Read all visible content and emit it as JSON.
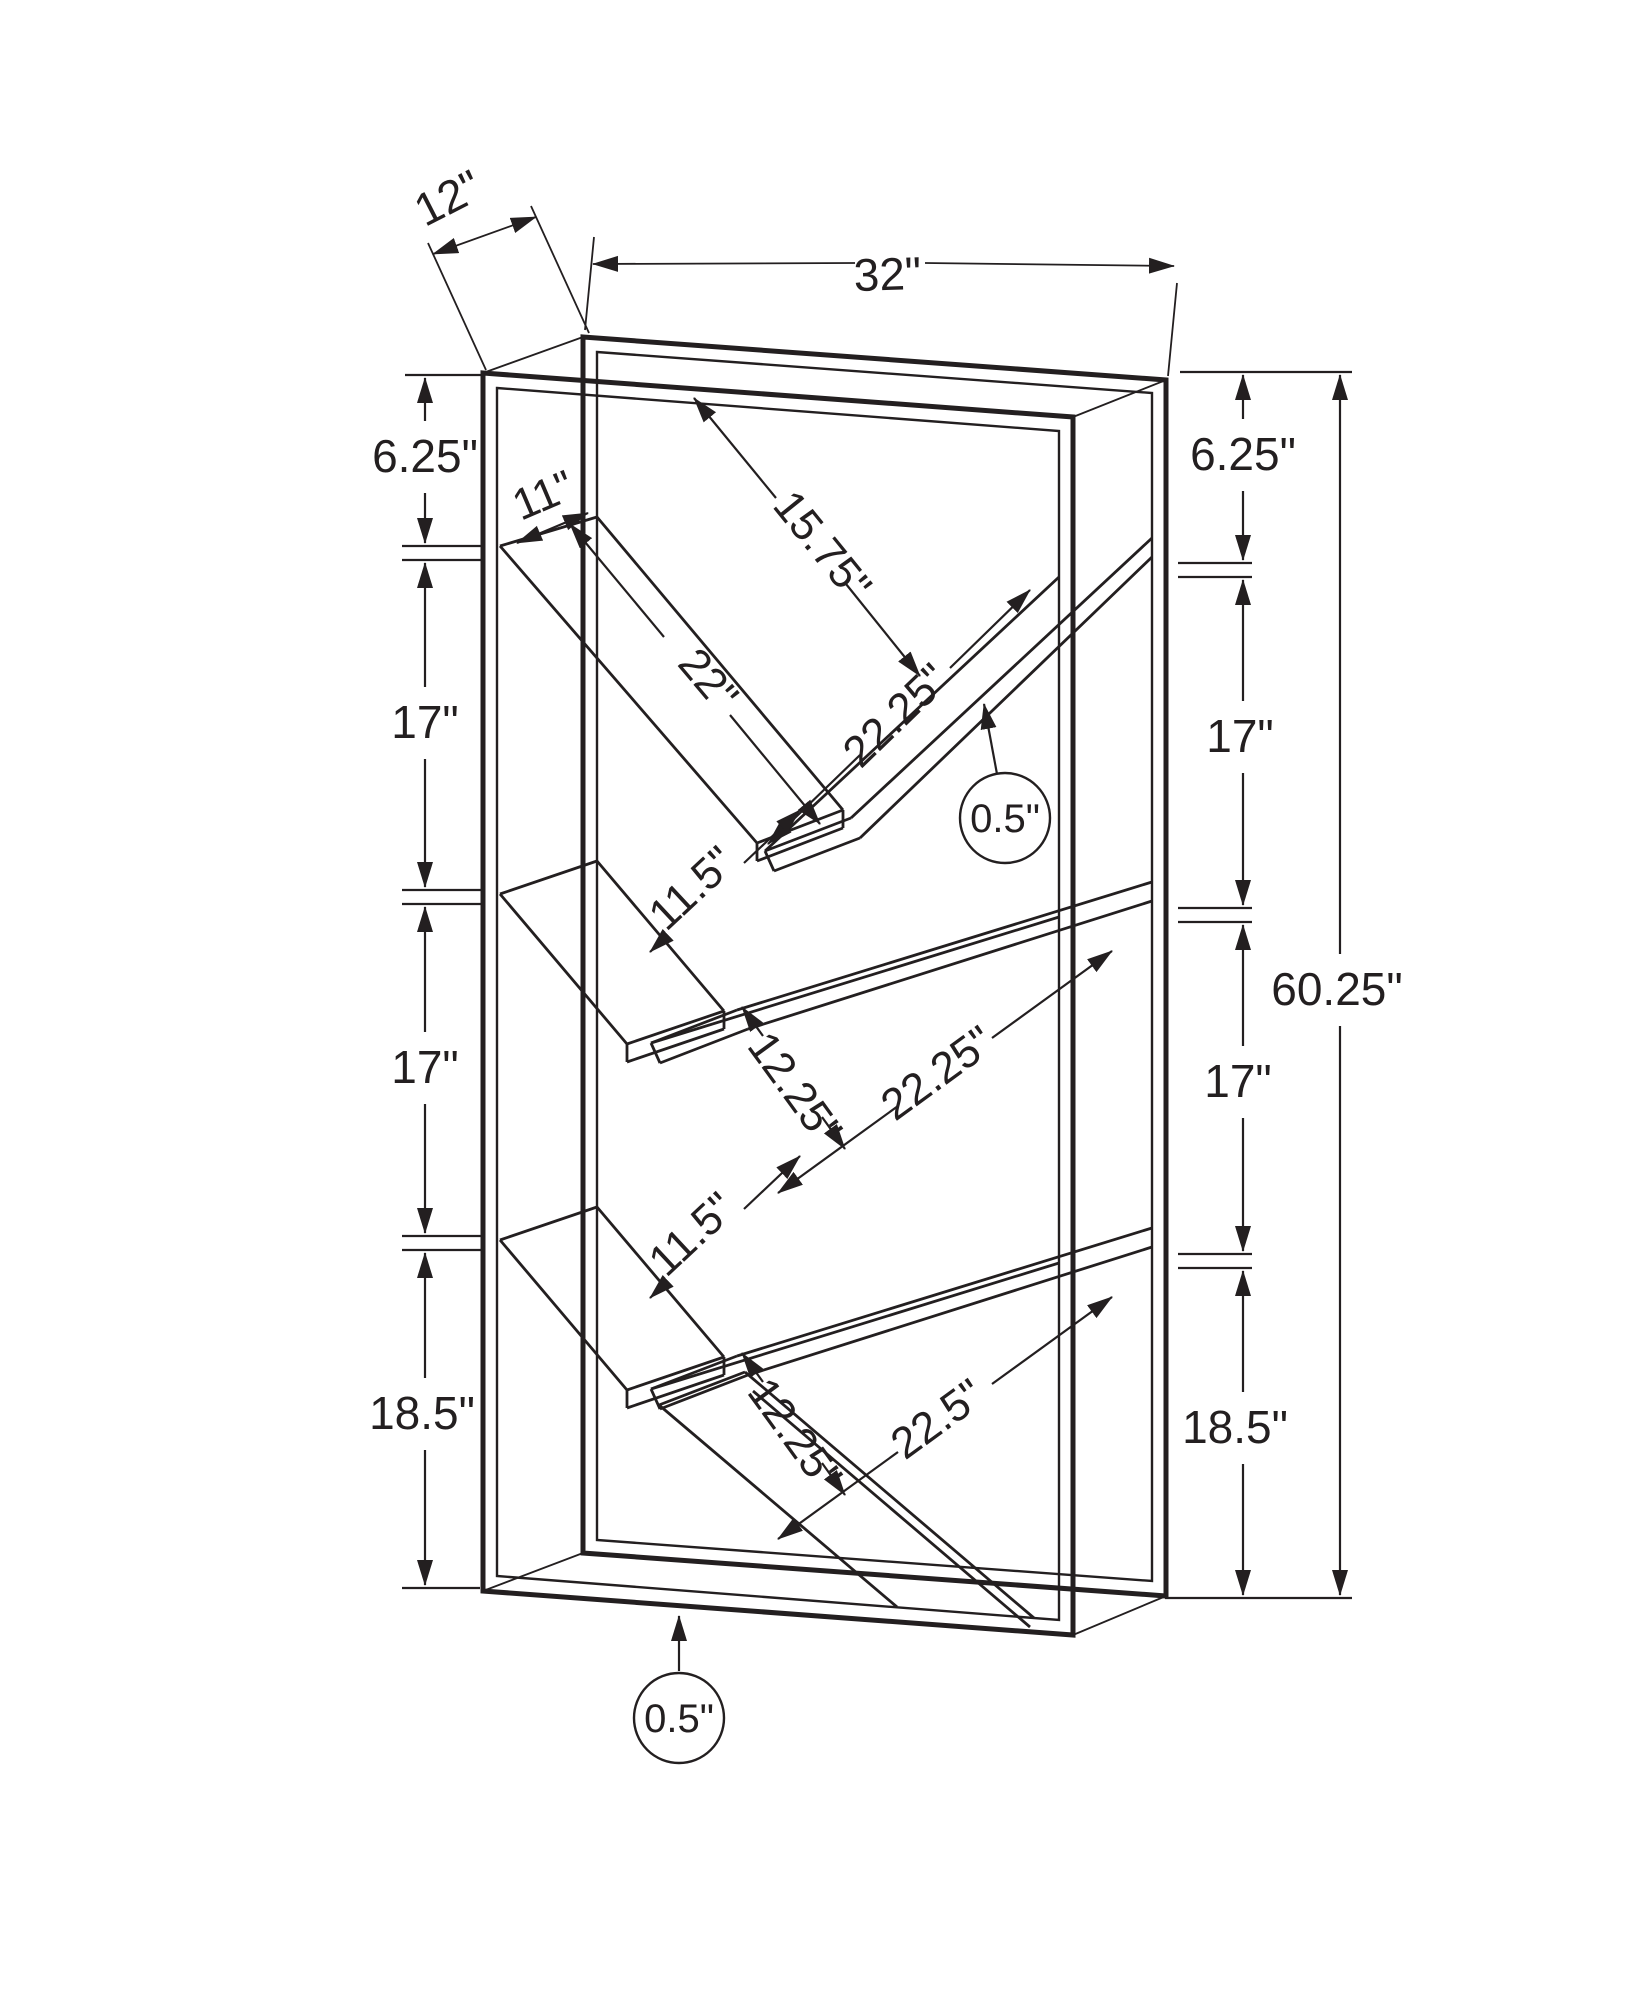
{
  "diagram": {
    "type": "furniture-dimension-drawing",
    "product": "v-shelf-bookcase-wireframe",
    "units": "inches",
    "line_color": "#231f20",
    "background_color": "#ffffff",
    "overall": {
      "width": "32\"",
      "depth": "12\"",
      "height": "60.25\""
    },
    "left_spacings": [
      "6.25\"",
      "17\"",
      "17\"",
      "18.5\""
    ],
    "right_spacings": [
      "6.25\"",
      "17\"",
      "17\"",
      "18.5\""
    ],
    "shelf_dimensions": {
      "top_shelf_width": "11\"",
      "top_clearance": "15.75\"",
      "top_left_shelf_length": "22\"",
      "top_right_shelf_length": "22.25\"",
      "middle_left_shelf_length": "9.25\"",
      "middle_opening": "11.5\"",
      "middle_gap": "12.25\"",
      "middle_right_shelf_length": "22.25\"",
      "lower_left_shelf_length": "9.25\"",
      "lower_opening": "11.5\"",
      "lower_gap": "12.25\"",
      "bottom_shelf_length": "22.5\"",
      "shelf_thickness": "0.5\"",
      "frame_thickness": "0.5\""
    },
    "labels": [
      {
        "id": "depth-12",
        "text": "12\"",
        "x": 455,
        "y": 212,
        "rot": -27,
        "size": 46
      },
      {
        "id": "width-32",
        "text": "32\"",
        "x": 888,
        "y": 290,
        "rot": -2,
        "size": 46
      },
      {
        "id": "left-6-25",
        "text": "6.25\"",
        "x": 425,
        "y": 472,
        "rot": 0,
        "size": 46
      },
      {
        "id": "left-17-a",
        "text": "17\"",
        "x": 425,
        "y": 738,
        "rot": 0,
        "size": 46
      },
      {
        "id": "left-17-b",
        "text": "17\"",
        "x": 425,
        "y": 1083,
        "rot": 0,
        "size": 46
      },
      {
        "id": "left-18-5",
        "text": "18.5\"",
        "x": 422,
        "y": 1429,
        "rot": 0,
        "size": 46
      },
      {
        "id": "right-6-25",
        "text": "6.25\"",
        "x": 1243,
        "y": 470,
        "rot": 0,
        "size": 46
      },
      {
        "id": "right-17-a",
        "text": "17\"",
        "x": 1240,
        "y": 752,
        "rot": 0,
        "size": 46
      },
      {
        "id": "right-17-b",
        "text": "17\"",
        "x": 1238,
        "y": 1097,
        "rot": 0,
        "size": 46
      },
      {
        "id": "right-18-5",
        "text": "18.5\"",
        "x": 1235,
        "y": 1443,
        "rot": 0,
        "size": 46
      },
      {
        "id": "height-60-25",
        "text": "60.25\"",
        "x": 1337,
        "y": 1005,
        "rot": 0,
        "size": 46
      },
      {
        "id": "diag-15-75",
        "text": "15.75\"",
        "x": 811,
        "y": 555,
        "rot": 51,
        "size": 44
      },
      {
        "id": "diag-22",
        "text": "22\"",
        "x": 697,
        "y": 689,
        "rot": 50,
        "size": 44
      },
      {
        "id": "diag-11",
        "text": "11\"",
        "x": 549,
        "y": 509,
        "rot": -23,
        "size": 44
      },
      {
        "id": "diag-22-25-top",
        "text": "22.25\"",
        "x": 906,
        "y": 726,
        "rot": -44,
        "size": 44
      },
      {
        "id": "diag-11-5-mid",
        "text": "11.5\"",
        "x": 702,
        "y": 899,
        "rot": -43,
        "size": 44
      },
      {
        "id": "diag-12-25-mid",
        "text": "12.25\"",
        "x": 783,
        "y": 1097,
        "rot": 54,
        "size": 44
      },
      {
        "id": "diag-22-25-mid",
        "text": "22.25\"",
        "x": 946,
        "y": 1085,
        "rot": -36,
        "size": 44
      },
      {
        "id": "diag-11-5-low",
        "text": "11.5\"",
        "x": 702,
        "y": 1245,
        "rot": -43,
        "size": 44
      },
      {
        "id": "diag-12-25-low",
        "text": "12.25\"",
        "x": 783,
        "y": 1443,
        "rot": 54,
        "size": 44
      },
      {
        "id": "diag-22-5",
        "text": "22.5\"",
        "x": 946,
        "y": 1431,
        "rot": -36,
        "size": 44
      },
      {
        "id": "callout-0-5-top",
        "text": "0.5\"",
        "x": 1005,
        "y": 832,
        "rot": 0,
        "size": 40
      },
      {
        "id": "callout-0-5-bottom",
        "text": "0.5\"",
        "x": 679,
        "y": 1732,
        "rot": 0,
        "size": 40
      }
    ]
  }
}
